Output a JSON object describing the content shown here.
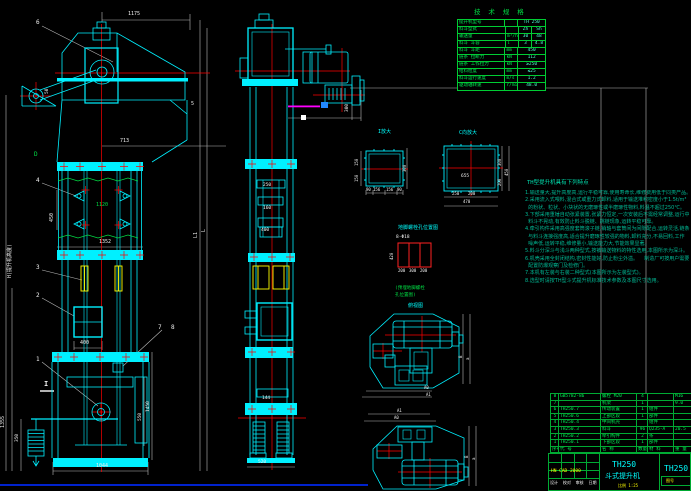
{
  "colors": {
    "cad_cyan": "#00f0ff",
    "cad_red": "#ff0000",
    "cad_green": "#00dd44",
    "cad_yellow": "#ffff00",
    "cad_magenta": "#ff00ff"
  },
  "left_view": {
    "dims": {
      "d1175": "1175",
      "d713": "713",
      "d450": "450",
      "d1120": "1120",
      "d1352": "1352",
      "d400": "400",
      "d50": "50",
      "d1355": "1355",
      "d350": "350",
      "d550": "550",
      "d1450": "1450",
      "d1044": "1044",
      "height_note": "H(提升机高度)",
      "dL": "L",
      "dL1": "L1"
    },
    "labels": {
      "p1": "1",
      "p2": "2",
      "p3": "3",
      "p4": "4",
      "p5": "5",
      "p6": "6",
      "p7": "7",
      "p8": "8",
      "pD": "D",
      "sec_i": "I"
    }
  },
  "middle_view": {
    "dims": {
      "d250": "250",
      "d160": "160",
      "d400": "400",
      "d144": "144",
      "d520": "520",
      "d300": "300"
    }
  },
  "section_i": {
    "caption": "I放大",
    "dims": {
      "l1": "150",
      "l2": "150",
      "r": "300",
      "b1": "90",
      "b2": "156",
      "b3": "156",
      "b4": "90"
    }
  },
  "section_c": {
    "caption": "C向放大",
    "dims": {
      "mid": "655",
      "r1": "300",
      "r2": "200",
      "r3": "450",
      "b1": "250",
      "b2": "200",
      "b3": "470"
    }
  },
  "foundation": {
    "caption": "地脚螺栓孔位置图",
    "bolt": "8-Φ18",
    "d420": "420",
    "b1": "200",
    "b2": "300",
    "b3": "200",
    "note1": "(预埋地脚螺栓",
    "note2": "孔位置图)"
  },
  "plan_views": {
    "caption": "俯视图",
    "top": {
      "a0": "A0",
      "a1": "A1",
      "b": "B",
      "a": "a"
    },
    "bottom": {
      "a0": "A0",
      "a1": "A1",
      "b": "B",
      "a": "a"
    }
  },
  "spec_table": {
    "title": "技 术 规 格",
    "rows": [
      {
        "l": "提升机型号",
        "u": "",
        "v1": "TH 250",
        "v2": ""
      },
      {
        "l": "料斗型式",
        "u": "",
        "v1": "Zh",
        "v2": "Sh"
      },
      {
        "l": "输送量",
        "u": "m³/h",
        "v1": "30",
        "v2": "48"
      },
      {
        "l": "料斗 斗容",
        "u": "l",
        "v1": "3",
        "v2": "4.8"
      },
      {
        "l": "料斗 斗距",
        "u": "mm",
        "v1": "450",
        "v2": ""
      },
      {
        "l": "链条 拉断力",
        "u": "kN",
        "v1": "112",
        "v2": ""
      },
      {
        "l": "链条 工作拉力",
        "u": "kN",
        "v1": "≥250",
        "v2": ""
      },
      {
        "l": "给料粒度",
        "u": "mm",
        "v1": "≤25",
        "v2": ""
      },
      {
        "l": "料斗运行速度",
        "u": "m/s",
        "v1": "1.2",
        "v2": ""
      },
      {
        "l": "驱动轴转速",
        "u": "r/min",
        "v1": "48.0",
        "v2": ""
      }
    ]
  },
  "notes": {
    "title": "TH型提升机具有下列特点",
    "lines": [
      "1.输送量大,提升高度高,运行平稳可靠,使用寿命长,维修费用低于同类产品。",
      "2.采用流入式喂料,混合式或重力式卸料,适用于输送堆积密度小于1.5t/m³",
      "  的粉状、粒状、小块状的无磨琢性或半磨琢性物料,料温不超过250℃。",
      "3.下部采用重锤自动张紧装置,张紧力恒定,一次安装后不需经常调整,运行中",
      "  料斗不晃动,有效防止料斗脱链、跳链现象,运转平稳可靠。",
      "4.牵引构件采用高强度套筒滚子链,销轴与套筒间为间隙配合,运转灵活,链条",
      "  与料斗连接强度高,适合提升磨琢性较强的物料,卸料充分,不易回料,工作",
      "  噪声低,运转平稳,维修量小,输送能力大,节能效果显著。",
      "5.料斗分深斗与浅斗两种型式,按被输送物料的特性选用,本图所示为深斗。",
      "6.机壳采用全封闭结构,密封性能好,防止粉尘外溢。    制造厂可按用户需要",
      "  配置防爆观察门及检修门。",
      "7.本机有左装与右装二种型式(本图所示为左装型式)。",
      "8.选型时请按TH型斗式提升机标准技术参数及本图尺寸选用。"
    ]
  },
  "bom": {
    "rows": [
      {
        "no": "8",
        "code": "GB5782-86",
        "name": "螺栓 M20",
        "qty": "4",
        "mat": "",
        "note": "M16"
      },
      {
        "no": "7",
        "code": "",
        "name": "机架",
        "qty": "1",
        "mat": "",
        "note": "9.0"
      },
      {
        "no": "6",
        "code": "TH250.7",
        "name": "传动装置",
        "qty": "1",
        "mat": "组件",
        "note": ""
      },
      {
        "no": "5",
        "code": "TH250.6",
        "name": "上部区段",
        "qty": "1",
        "mat": "部件",
        "note": ""
      },
      {
        "no": "4",
        "code": "TH250.4",
        "name": "中间机壳",
        "qty": "",
        "mat": "组件",
        "note": ""
      },
      {
        "no": "3",
        "code": "TH250.3",
        "name": "料斗",
        "qty": "96",
        "mat": "Q235-A",
        "note": "20.5"
      },
      {
        "no": "2",
        "code": "TH250.2",
        "name": "牵引构件",
        "qty": "2",
        "mat": "条",
        "note": ""
      },
      {
        "no": "1",
        "code": "TH250.1",
        "name": "下部区段",
        "qty": "1",
        "mat": "部件",
        "note": ""
      }
    ],
    "header": {
      "no": "序号",
      "code": "代 号",
      "name": "名 称",
      "qty": "数量",
      "mat": "材 料",
      "note": "重 量"
    }
  },
  "title_block": {
    "watermark": "HN CAD 2000",
    "sign_row": "设计  校对  审核  日期",
    "model": "TH250",
    "name": "斗式提升机",
    "scale": "比例 1:25",
    "side_model": "TH250",
    "side_note": "图号"
  }
}
